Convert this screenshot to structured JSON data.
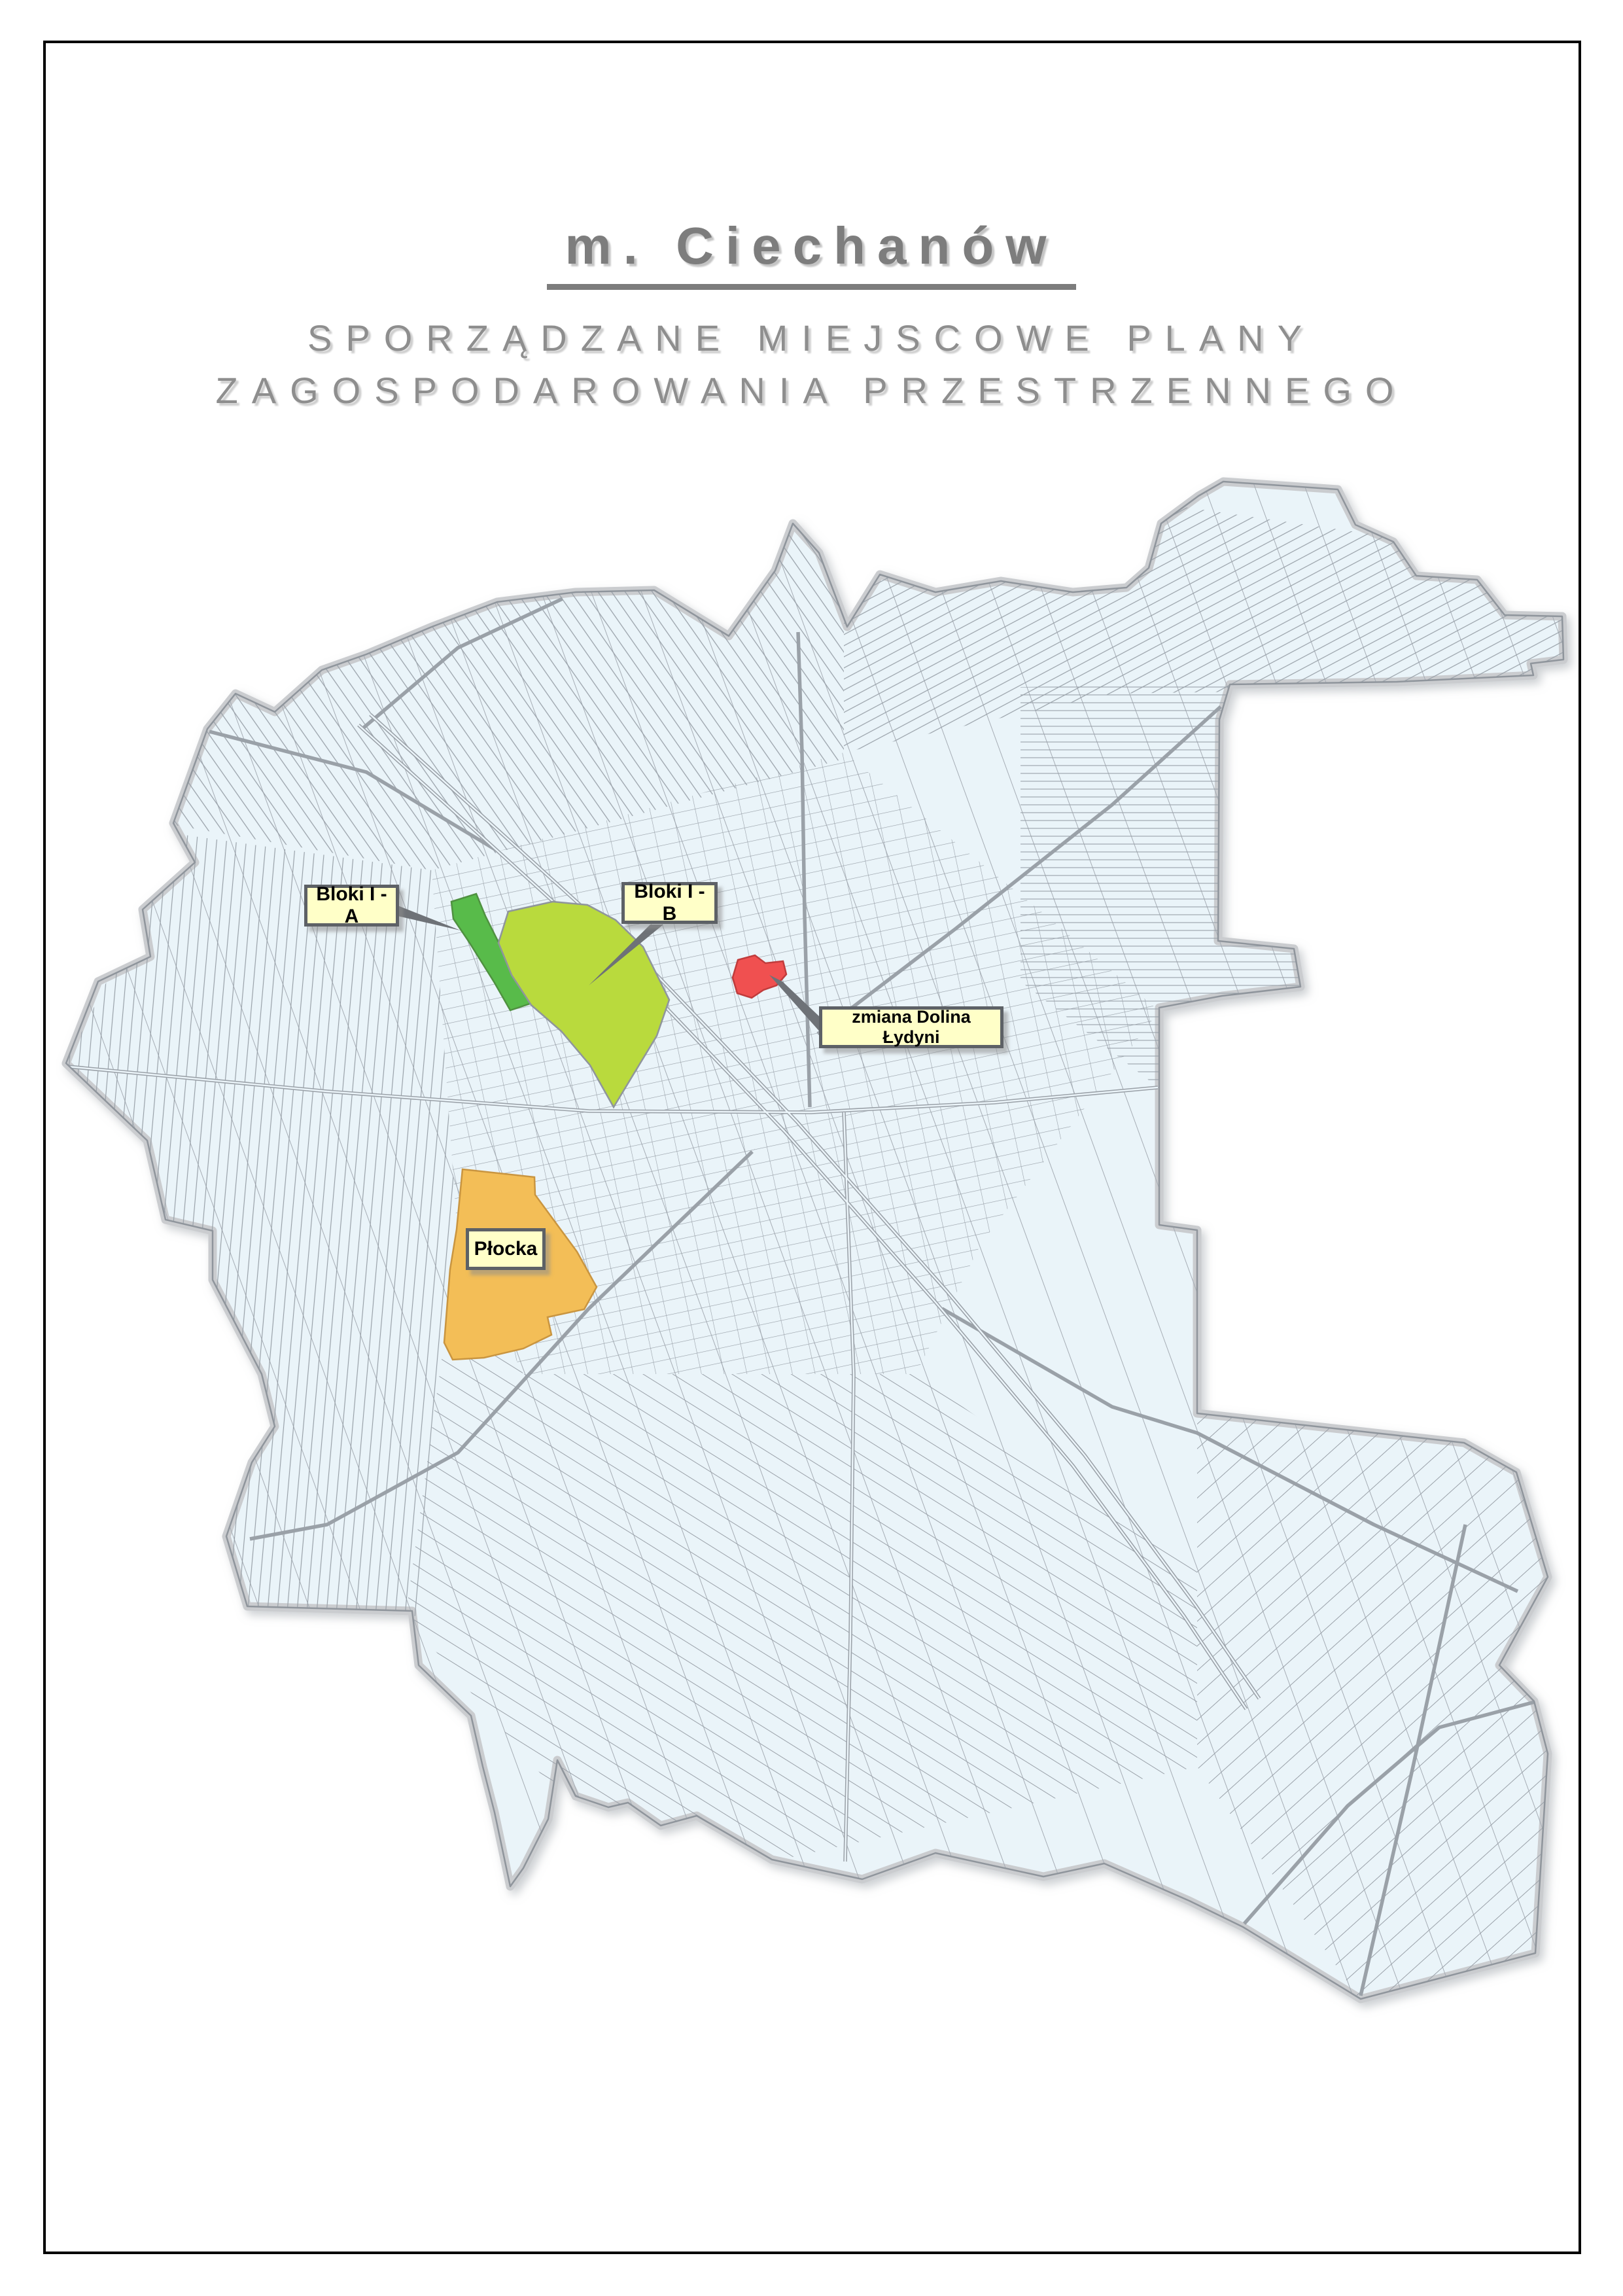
{
  "header": {
    "title": "m. Ciechanów",
    "subtitle_line1": "SPORZĄDZANE MIEJSCOWE PLANY",
    "subtitle_line2": "ZAGOSPODAROWANIA PRZESTRZENNEGO"
  },
  "map": {
    "zones": [
      {
        "id": "bloki-1a",
        "label": "Bloki I - A",
        "color": "#58bb4a"
      },
      {
        "id": "bloki-1b",
        "label": "Bloki I - B",
        "color": "#b9da3d"
      },
      {
        "id": "dolina-lydyni",
        "label": "zmiana Dolina Łydyni",
        "color": "#f05050"
      },
      {
        "id": "plocka",
        "label": "Płocka",
        "color": "#f3be57"
      }
    ],
    "colors": {
      "map_fill": "#eaf4f9",
      "parcel_line": "#98a0a8",
      "boundary_band": "#cacccf",
      "boundary_line": "#8f959c",
      "label_fill": "#ffffc8",
      "label_border": "#5d6166"
    }
  }
}
